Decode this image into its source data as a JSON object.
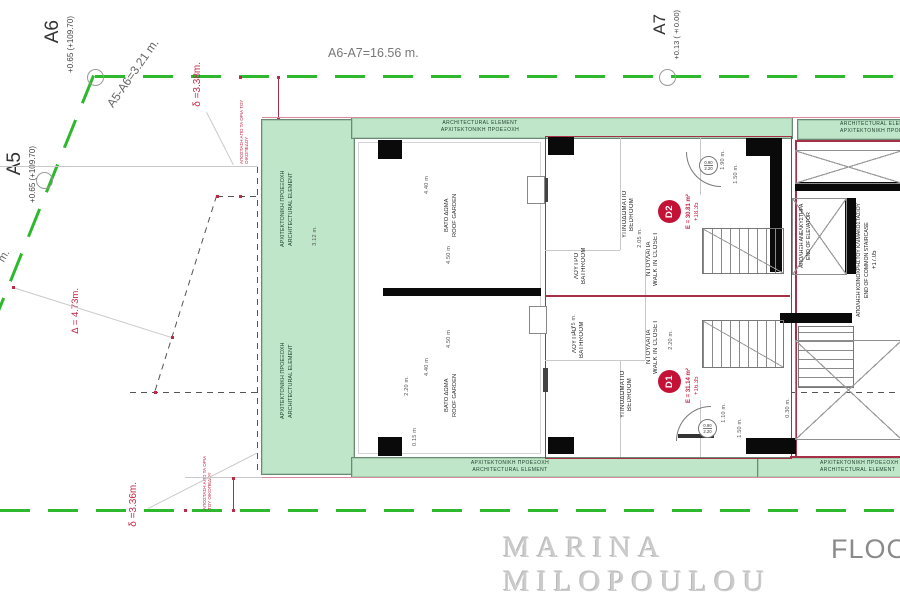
{
  "title_block": {
    "watermark": "MARINA MILOPOULOU",
    "plan_label": "FLOOR"
  },
  "boundary": {
    "points": {
      "a5": {
        "name": "A5",
        "elevation": "+0.65 (+109.70)"
      },
      "a6": {
        "name": "A6",
        "elevation": "+0.65 (+109.70)"
      },
      "a7": {
        "name": "A7",
        "elevation": "+0.13 (±0.00)"
      }
    },
    "segments": {
      "a5_a6": "A5-A6=3.21 m.",
      "a6_a7": "A6-A7=16.56 m.",
      "left_fragment": "m."
    },
    "setbacks": {
      "top": "δ =3.38m.",
      "bottom": "δ =3.36m.",
      "diagonal": "Δ = 4.73m.",
      "note": "ΑΠΟΣΤΑΣΗ ΑΠΟ ΤΑ ΟΡΙΑ ΤΟΥ ΟΙΚΟΠΕΔΟΥ"
    }
  },
  "bands": {
    "en": "ARCHITECTURAL ELEMENT",
    "gr": "ΑΡΧΙΤΕΚΤΟΝΙΚΗ ΠΡΟΕΞΟΧΗ"
  },
  "roof_garden": {
    "gr": "ΒΑΤΟ ΔΩΜΑ",
    "en": "ROOF GARDEN"
  },
  "rooms": {
    "bedroom_gr": "ΥΠΝΟΔΩΜΑΤΙΟ",
    "bedroom_en": "BEDROOM",
    "closet_gr": "ΝΤΟΥΛΑΠΑ",
    "closet_en": "WALK IN CLOSET",
    "bath_gr": "ΛΟΥΤΡΟ",
    "bath_en": "BATHROOM"
  },
  "units": {
    "d1": {
      "id": "D1",
      "area": "E = 31.14 m²",
      "level": "+16.35"
    },
    "d2": {
      "id": "D2",
      "area": "E = 30.81 m²",
      "level": "+18.35"
    }
  },
  "core": {
    "elevator_gr": "ΑΠΟΛΗΞΗ ΑΝΕΛΚΥΣΤΗΡΑ",
    "elevator_en": "END OF ELEVATOR",
    "staircase_gr": "ΑΠΟΛΗΞΗ ΚΟΙΝΟΧΡΗΣΤΟΥ ΚΛΙΜΑΚΟΣΤΑΣΙΟΥ",
    "staircase_en": "END OF COMMON STAIRCASE",
    "staircase_level": "+17.05"
  },
  "door_tag": {
    "width": "0.90",
    "height": "2.20"
  },
  "dims": [
    {
      "label": "4.40 m"
    },
    {
      "label": "4.50 m"
    },
    {
      "label": "4.40 m"
    },
    {
      "label": "4.50 m"
    },
    {
      "label": "0.15 m"
    },
    {
      "label": "3.12 m."
    },
    {
      "label": "2.05 m."
    },
    {
      "label": "1.75 m."
    },
    {
      "label": "2.20 m."
    },
    {
      "label": "1.90 m."
    },
    {
      "label": "1.50 m."
    },
    {
      "label": "1.10 m."
    },
    {
      "label": "1.50 m."
    },
    {
      "label": "0.30 m."
    },
    {
      "label": "2.20 m."
    }
  ],
  "colors": {
    "site_boundary": "#2eb82e",
    "band_fill": "#bfe6c9",
    "unit_outline": "#a53048",
    "badge": "#c41236",
    "dimension_red": "#c02848",
    "wall": "#0a0a0a"
  }
}
